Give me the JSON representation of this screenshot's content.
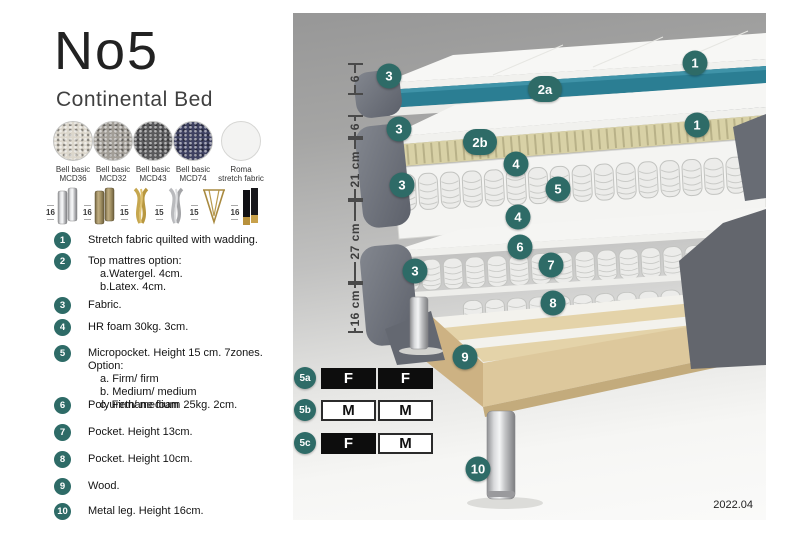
{
  "header": {
    "title": "No5",
    "subtitle": "Continental Bed"
  },
  "fabrics": [
    {
      "name": "Bell basic",
      "code": "MCD36",
      "color": "#dcd7cc"
    },
    {
      "name": "Bell basic",
      "code": "MCD32",
      "color": "#a29e97"
    },
    {
      "name": "Bell basic",
      "code": "MCD43",
      "color": "#5a5a5c"
    },
    {
      "name": "Bell basic",
      "code": "MCD74",
      "color": "#3e4161"
    },
    {
      "name": "Roma",
      "code": "stretch fabric",
      "color": "#f3f3f2"
    }
  ],
  "legs": [
    {
      "height": "16",
      "type": "cylinder-chrome"
    },
    {
      "height": "16",
      "type": "cylinder-wood"
    },
    {
      "height": "15",
      "type": "twist-gold"
    },
    {
      "height": "15",
      "type": "twist-silver"
    },
    {
      "height": "15",
      "type": "hairpin-brass"
    },
    {
      "height": "16",
      "type": "square-black-brass-tip"
    }
  ],
  "spec_items": [
    {
      "num": "1",
      "lines": [
        "Stretch fabric quilted with wadding."
      ]
    },
    {
      "num": "2",
      "lines": [
        "Top mattres option:",
        "a.Watergel. 4cm.",
        "b.Latex. 4cm."
      ]
    },
    {
      "num": "3",
      "lines": [
        "Fabric."
      ]
    },
    {
      "num": "4",
      "lines": [
        "HR foam 30kg. 3cm."
      ]
    },
    {
      "num": "5",
      "lines": [
        "Micropocket. Height 15 cm. 7zones. Option:",
        "a. Firm/ firm",
        "b. Medium/ medium",
        "c. Firm/ medium"
      ]
    },
    {
      "num": "6",
      "lines": [
        "Polyurethane foam 25kg. 2cm."
      ]
    },
    {
      "num": "7",
      "lines": [
        "Pocket. Height 13cm."
      ]
    },
    {
      "num": "8",
      "lines": [
        "Pocket. Height 10cm."
      ]
    },
    {
      "num": "9",
      "lines": [
        "Wood."
      ]
    },
    {
      "num": "10",
      "lines": [
        "Metal leg. Height 16cm."
      ]
    }
  ],
  "diagram": {
    "dimensions": [
      "6",
      "6",
      "21 cm",
      "27 cm",
      "16 cm"
    ],
    "callouts": {
      "c1a": "1",
      "c1b": "1",
      "c2a": "2a",
      "c2b": "2b",
      "c3a": "3",
      "c3b": "3",
      "c3c": "3",
      "c3d": "3",
      "c4a": "4",
      "c4b": "4",
      "c5": "5",
      "c6": "6",
      "c7": "7",
      "c8": "8",
      "c9": "9",
      "c10": "10"
    },
    "firmness_table": {
      "rows": [
        {
          "id": "5a",
          "cells": [
            "F",
            "F"
          ],
          "variants": [
            "dark",
            "dark"
          ]
        },
        {
          "id": "5b",
          "cells": [
            "M",
            "M"
          ],
          "variants": [
            "light",
            "light"
          ]
        },
        {
          "id": "5c",
          "cells": [
            "F",
            "M"
          ],
          "variants": [
            "dark",
            "light"
          ]
        }
      ]
    },
    "version": "2022.04"
  },
  "colors": {
    "accent_teal": "#2e6b67",
    "top_mattress_core": "#2b7e93",
    "fabric_gray": "#6a6e76",
    "latex_layer": "#d8d1a6",
    "wood": "#ddc89c",
    "chrome": "#d9dadc",
    "firm_cell_black": "#0d0d0d"
  }
}
